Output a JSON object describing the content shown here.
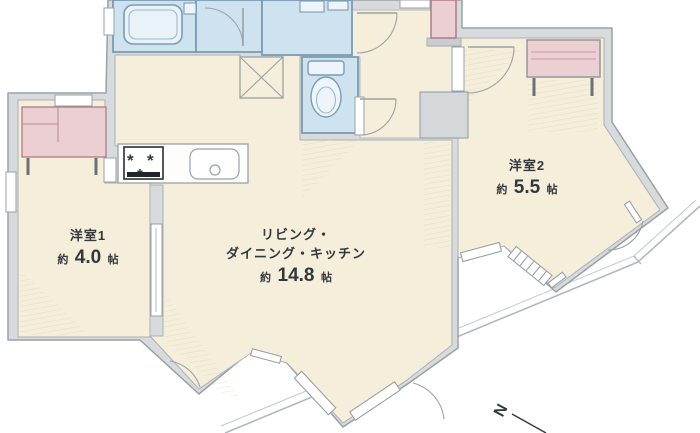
{
  "plan": {
    "rooms": {
      "living": {
        "name_line1": "リビング・",
        "name_line2": "ダイニング・キッチン",
        "size_prefix": "約",
        "size_value": "14.8",
        "size_unit": "帖"
      },
      "bedroom1": {
        "name": "洋室1",
        "size_prefix": "約",
        "size_value": "4.0",
        "size_unit": "帖"
      },
      "bedroom2": {
        "name": "洋室2",
        "size_prefix": "約",
        "size_value": "5.5",
        "size_unit": "帖"
      }
    },
    "compass": {
      "label": "N"
    },
    "icons": {
      "stove_burner_glyph": "*"
    },
    "colors": {
      "floor": "#f4eeda",
      "wet_room": "#cfe2ef",
      "fixture_fill": "#e9f2f8",
      "closet_pink": "#eccfd3",
      "wall_fill": "#d8dbdd",
      "wall_line": "#9aa1a6",
      "wet_line": "#7b9cb2",
      "hatch": "#ddd3b6",
      "text": "#33383d"
    }
  }
}
